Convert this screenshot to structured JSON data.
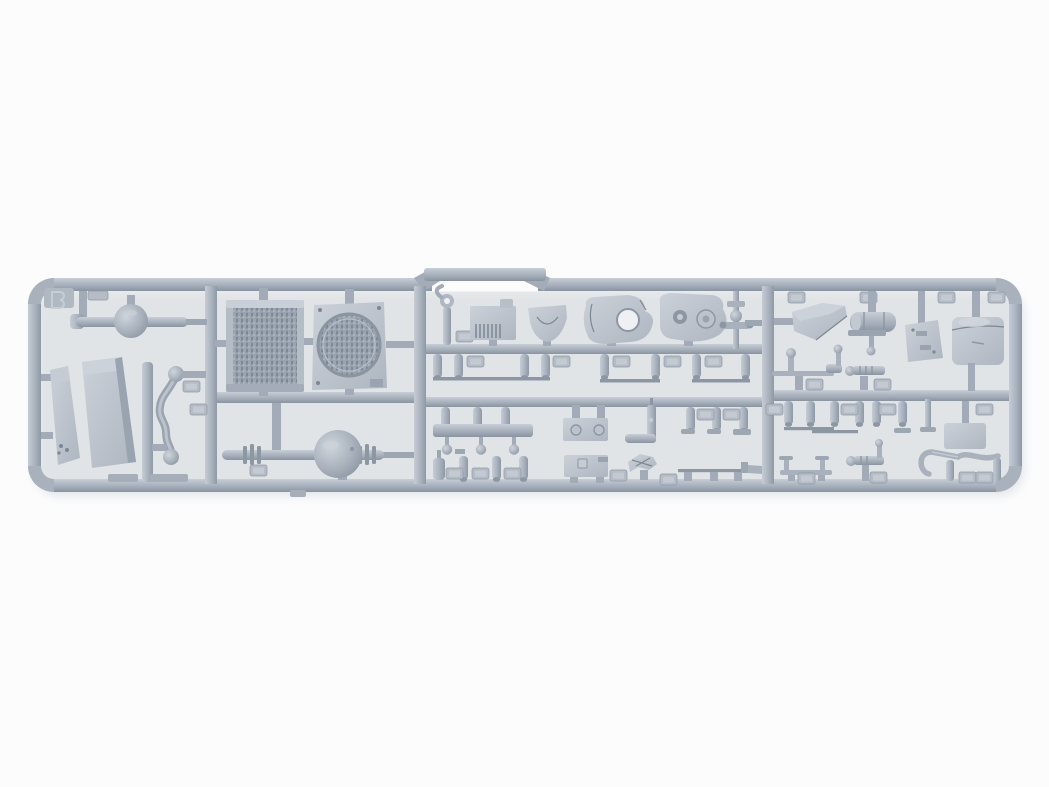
{
  "scene": {
    "type": "photograph",
    "subject": "plastic model kit sprue",
    "alt": "Light gray injection-molded plastic sprue (runner frame) of a vehicle model kit on a white background, holding a radiator core, fan shroud panel, front and rear axles with spherical differentials, leaf-spring plates, transfer-case housings, fuel tank box, cylinder tank, pipes, rods, levers and many small pegs with embossed part-number tabs"
  },
  "palette": {
    "bg": "#fcfcfd",
    "plastic-base": "#aeb7c2",
    "plastic-light": "#c9cfd7",
    "plastic-dark": "#8d97a3",
    "plastic-deep": "#7c8794",
    "mesh-dark": "#7e8995",
    "shadow": "#ccd1d6",
    "hole": "#eef0f3",
    "tab-face": "#b5bcc6",
    "tab-inner": "#c4cad2"
  },
  "parts": [
    {
      "name": "sprue-frame"
    },
    {
      "name": "sprue-letter-tab"
    },
    {
      "name": "front-axle"
    },
    {
      "name": "leaf-spring-plate-narrow"
    },
    {
      "name": "leaf-spring-plate-wide"
    },
    {
      "name": "s-shaped-pipe"
    },
    {
      "name": "radiator-core"
    },
    {
      "name": "fan-shroud-panel"
    },
    {
      "name": "rear-axle"
    },
    {
      "name": "towing-hook-rod"
    },
    {
      "name": "ribbed-generator-block"
    },
    {
      "name": "mounting-bracket"
    },
    {
      "name": "transfer-case-left"
    },
    {
      "name": "transfer-case-right"
    },
    {
      "name": "steering-shaft"
    },
    {
      "name": "linkage-bar-with-ball-pins"
    },
    {
      "name": "bolt-plate-upper"
    },
    {
      "name": "bolt-plate-lower"
    },
    {
      "name": "elbow-pipe"
    },
    {
      "name": "jagged-bracket"
    },
    {
      "name": "fuel-line-rod"
    },
    {
      "name": "wedge-scoop"
    },
    {
      "name": "cylinder-tank"
    },
    {
      "name": "clip-panel"
    },
    {
      "name": "storage-box"
    },
    {
      "name": "tie-rod-lever"
    },
    {
      "name": "splined-shaft-upper"
    },
    {
      "name": "t-post-rod"
    },
    {
      "name": "splined-shaft-lower"
    },
    {
      "name": "crank-handle"
    },
    {
      "name": "flat-plate-right"
    },
    {
      "name": "cylindrical-pegs"
    },
    {
      "name": "part-number-tabs"
    }
  ]
}
